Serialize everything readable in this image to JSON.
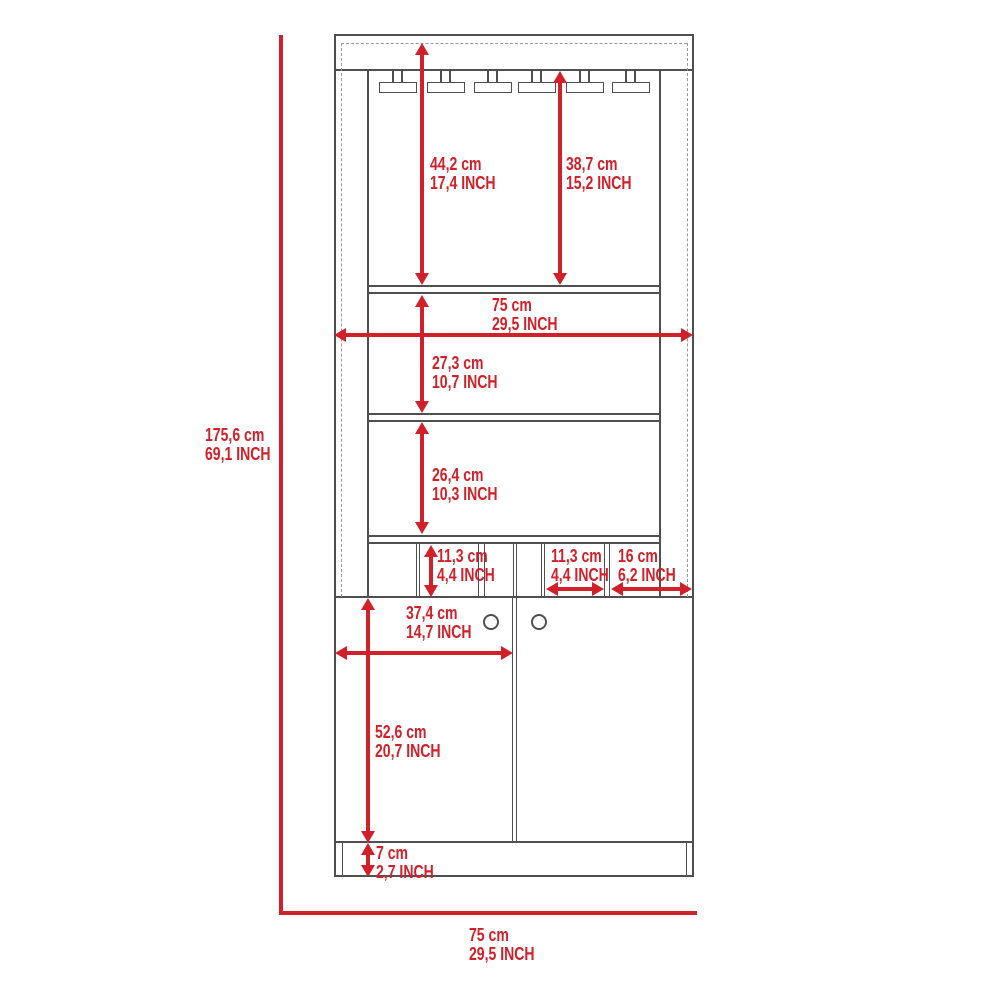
{
  "dims": {
    "overall_height": {
      "cm": "175,6 cm",
      "inch": "69,1 INCH"
    },
    "glasses_left": {
      "cm": "44,2 cm",
      "inch": "17,4 INCH"
    },
    "glasses_right": {
      "cm": "38,7 cm",
      "inch": "15,2 INCH"
    },
    "width_mid": {
      "cm": "75 cm",
      "inch": "29,5 INCH"
    },
    "middle_shelf": {
      "cm": "27,3 cm",
      "inch": "10,7 INCH"
    },
    "lower_shelf": {
      "cm": "26,4 cm",
      "inch": "10,3 INCH"
    },
    "cubby_height": {
      "cm": "11,3 cm",
      "inch": "4,4 INCH"
    },
    "cubby_width": {
      "cm": "11,3 cm",
      "inch": "4,4 INCH"
    },
    "cubby_depth": {
      "cm": "16 cm",
      "inch": "6,2 INCH"
    },
    "door_width": {
      "cm": "37,4 cm",
      "inch": "14,7 INCH"
    },
    "door_height": {
      "cm": "52,6 cm",
      "inch": "20,7 INCH"
    },
    "base_height": {
      "cm": "7 cm",
      "inch": "2,7 INCH"
    },
    "overall_width": {
      "cm": "75 cm",
      "inch": "29,5 INCH"
    }
  },
  "colors": {
    "dimension_red": "#d1202a",
    "outline_gray": "#4f4f4f",
    "dashed_gray": "#999999"
  }
}
